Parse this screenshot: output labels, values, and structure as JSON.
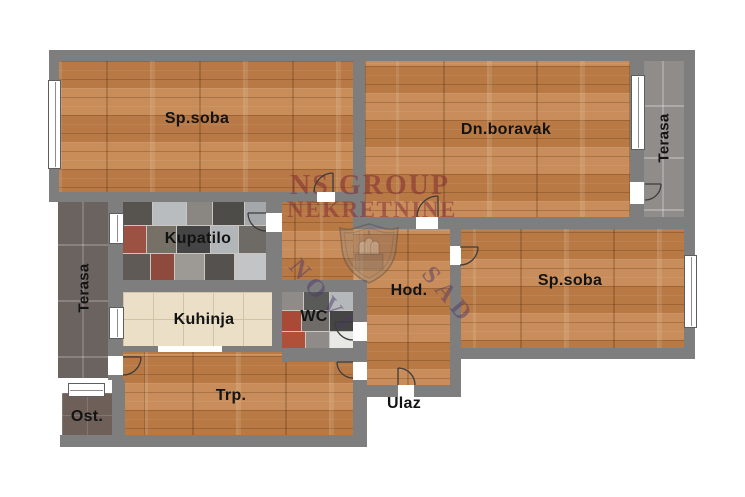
{
  "watermark": {
    "brand_line1": "NS GROUP",
    "brand_line2": "NEKRETNINE",
    "city_word1": "NOVI",
    "city_word2": "SAD"
  },
  "rooms": {
    "sp_soba_1": "Sp.soba",
    "dn_boravak": "Dn.boravak",
    "terasa_right": "Terasa",
    "kupatilo": "Kupatilo",
    "terasa_left": "Terasa",
    "kuhinja": "Kuhinja",
    "wc": "WC",
    "hodnik": "Hod.",
    "sp_soba_2": "Sp.soba",
    "trpezarija": "Trp.",
    "ulaz": "Ulaz",
    "ostava": "Ost."
  },
  "colors": {
    "wall": "#7e7e7e",
    "wood": "#c0824e",
    "kitchen_tile": "#ebe0c7",
    "terrace_left_tile": "#6b6360",
    "terrace_right_tile": "#8f8c8a",
    "brand_red": "#7d2330",
    "city_purple": "#4b3769"
  }
}
